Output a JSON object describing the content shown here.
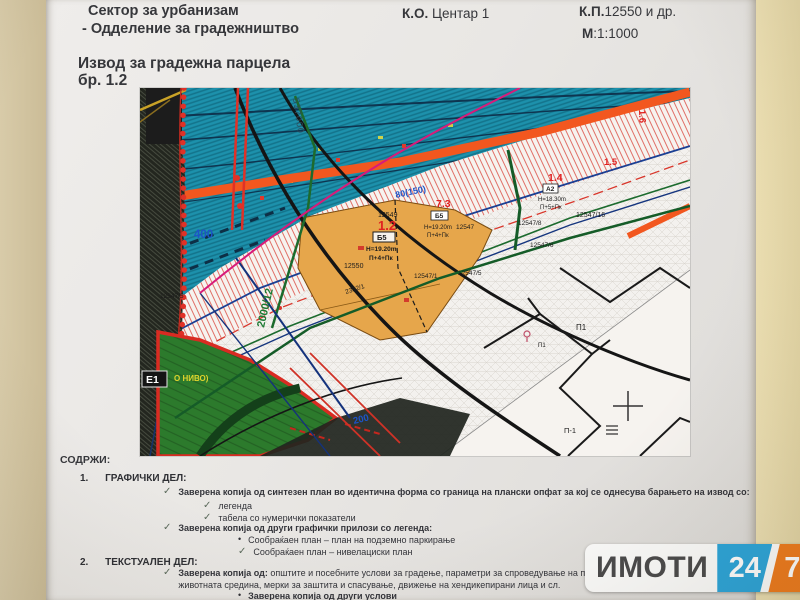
{
  "header": {
    "sector": "Сектор за урбанизам",
    "department": "- Одделение за градежништво",
    "ko_label": "К.О.",
    "ko_value": " Центар 1",
    "kp_label": "К.П.",
    "kp_value": "12550 и др.",
    "scale_label": "М",
    "scale_value": ":1:1000",
    "title": "Извод за градежна парцела",
    "title_number": "бр. 1.2"
  },
  "contents": {
    "heading": "СОДРЖИ:",
    "check": "✓",
    "bullet": "•",
    "s1_num": "1.",
    "s1_title": "ГРАФИЧКИ ДЕЛ:",
    "i1": "Заверена копија од синтезен план во идентична форма со граница на плански опфат за кој се однесува барањето на извод со:",
    "i2": "легенда",
    "i3": "табела со нумерички показатели",
    "i4": "Заверена копија од други графички прилози со легенда:",
    "i5": "Сообраќаен план – план на подземно паркирање",
    "i6": "Сообраќаен план – нивелациски план",
    "s2_num": "2.",
    "s2_title": "ТЕКСТУАЛЕН ДЕЛ:",
    "i7_bold": "Заверена копија од:",
    "i7_rest": " општите и посебните услови за градење, параметри за спроведување на планот, заштита и животната средина, мерки за заштита и спасување, движење на хендикепирани лица и сл.",
    "i8": "Заверена копија од други услови"
  },
  "map": {
    "labels": [
      "537000",
      "80(150)",
      "400",
      "200",
      "2000/12",
      "1.2",
      "7.3",
      "1.4",
      "1.5",
      "1.6",
      "Б5",
      "H=19.20m",
      "П+4+Пк",
      "12550",
      "12549",
      "12547/1",
      "12547/5",
      "12547/16",
      "12547/8",
      "12547/6",
      "2352/1",
      "Б5",
      "H=19.20m",
      "П+4+Пк",
      "12547",
      "А2",
      "H=18.30m",
      "П+5+Пк",
      "Е1",
      "О НИВО)",
      "П1",
      "П1",
      "П-1",
      "12547/5"
    ],
    "colors": {
      "water_zone": "#1d91ac",
      "main_road": "#f2571f",
      "subject_parcel": "#e6a64b",
      "green_area": "#2c7a2c",
      "boundary_red": "#e03127",
      "label_red": "#e02020",
      "label_blue": "#1d54c8"
    }
  },
  "watermark": {
    "brand": "ИМОТИ",
    "hours": "24",
    "days": "7"
  }
}
